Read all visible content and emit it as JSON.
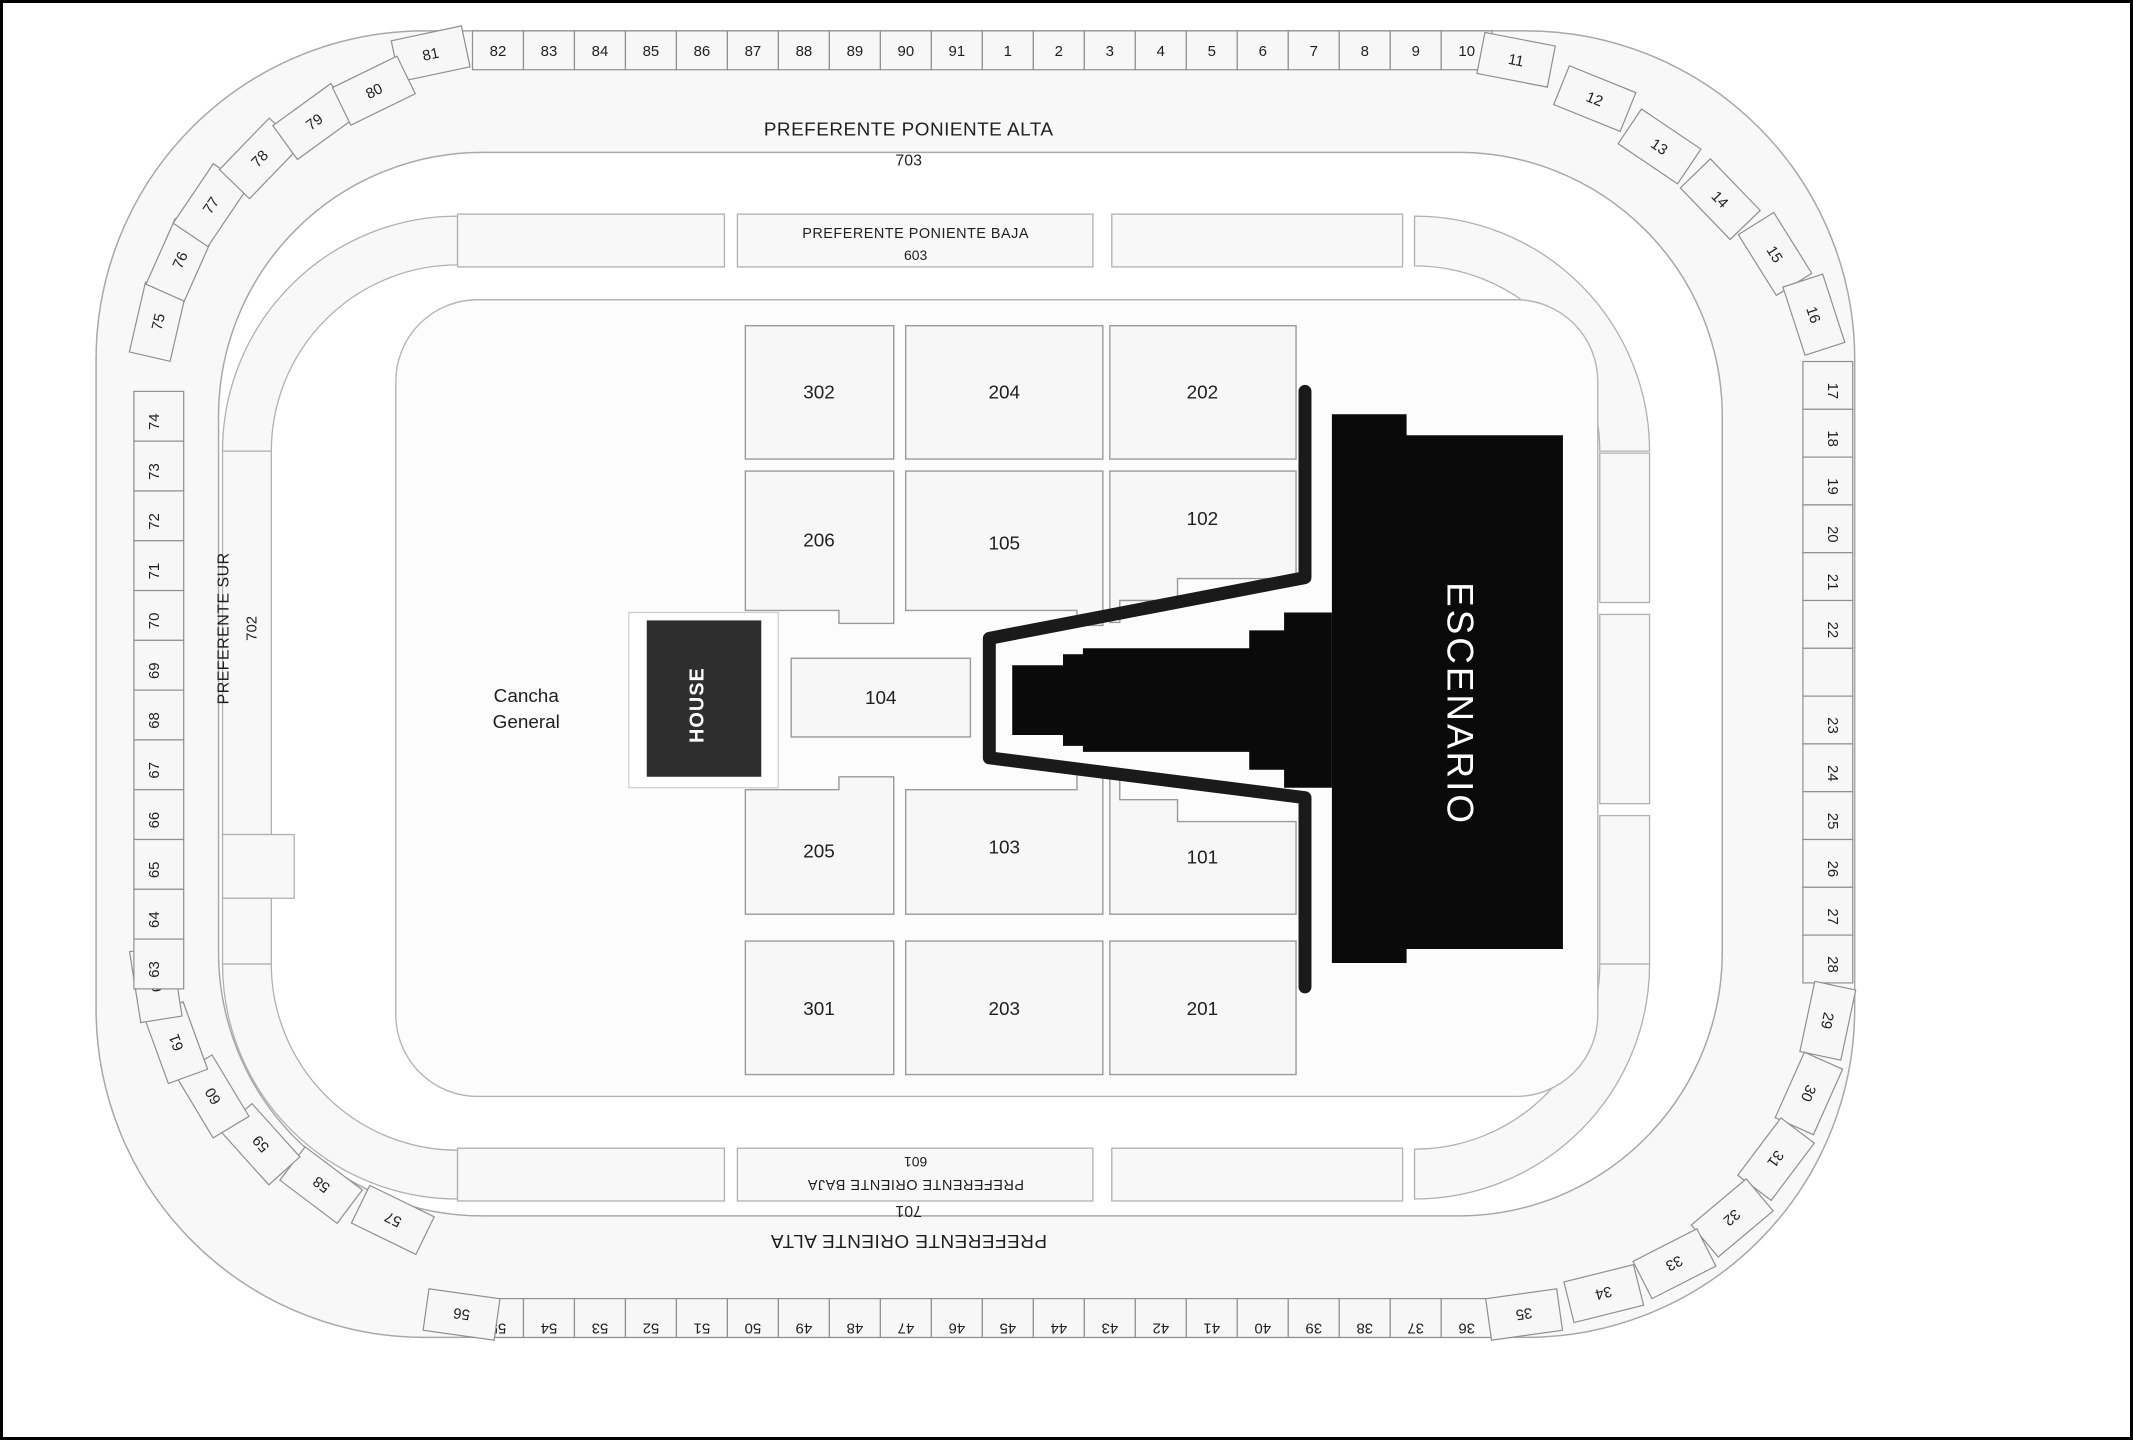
{
  "colors": {
    "stage": "#0a0a0a",
    "house": "#2e2e2e",
    "barrier": "#1a1a1a",
    "section_fill": "#f7f7f7",
    "ring_fill": "#f8f8f8",
    "outline": "#9a9a9a",
    "text": "#1f1f1f",
    "stage_text": "#ffffff"
  },
  "outer_ring": {
    "top_label": {
      "title": "PREFERENTE PONIENTE ALTA",
      "number": "703"
    },
    "bottom_label": {
      "title": "PREFERENTE ORIENTE ALTA",
      "number": "701"
    },
    "left_label": {
      "title": "PREFERENTE SUR",
      "number": "702"
    },
    "top_end_left": "81",
    "top_straight": [
      "82",
      "83",
      "84",
      "85",
      "86",
      "87",
      "88",
      "89",
      "90",
      "91",
      "1",
      "2",
      "3",
      "4",
      "5",
      "6",
      "7",
      "8",
      "9",
      "10"
    ],
    "top_end_right": "11",
    "corner_ne": [
      "12",
      "13",
      "14",
      "15",
      "16"
    ],
    "right_column": [
      "17",
      "18",
      "19",
      "20",
      "21",
      "22",
      "",
      "23",
      "24",
      "25",
      "26",
      "27",
      "28"
    ],
    "corner_se": [
      "29",
      "30",
      "31",
      "32",
      "33",
      "34"
    ],
    "bottom_end_right": "35",
    "bottom_straight": [
      "55",
      "54",
      "53",
      "52",
      "51",
      "50",
      "49",
      "48",
      "47",
      "46",
      "45",
      "44",
      "43",
      "42",
      "41",
      "40",
      "39",
      "38",
      "37",
      "36"
    ],
    "bottom_end_left": "56",
    "corner_sw": [
      "57",
      "58",
      "59",
      "60",
      "61",
      "62"
    ],
    "left_column": [
      "74",
      "73",
      "72",
      "71",
      "70",
      "69",
      "68",
      "67",
      "66",
      "65",
      "64",
      "63"
    ],
    "corner_nw": [
      "75",
      "76",
      "77",
      "78",
      "79",
      "80"
    ]
  },
  "inner_ring": {
    "top_label": {
      "title": "PREFERENTE PONIENTE BAJA",
      "number": "603"
    },
    "bottom_label": {
      "title": "PREFERENTE ORIENTE BAJA",
      "number": "601"
    }
  },
  "floor": {
    "general_area_lines": [
      "Cancha",
      "General"
    ],
    "sections": [
      [
        "302",
        "204",
        "202"
      ],
      [
        "206",
        "105",
        "102"
      ],
      [
        "205",
        "103",
        "101"
      ],
      [
        "301",
        "203",
        "201"
      ]
    ],
    "center_section": "104",
    "house_label": "HOUSE"
  },
  "stage": {
    "label": "ESCENARIO"
  }
}
